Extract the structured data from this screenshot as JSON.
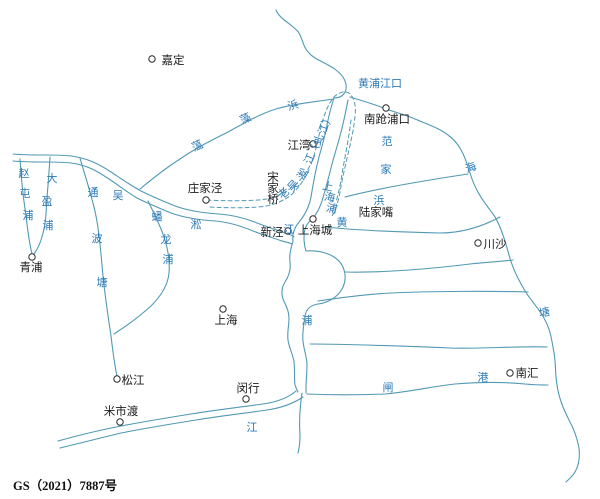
{
  "map": {
    "title": "上海水系历史地图",
    "footer": "GS（2021）7887号",
    "colors": {
      "river": "#5199b4",
      "label_blue": "#2b7ab8",
      "label_black": "#1b1b1b",
      "background": "#ffffff"
    },
    "towns": [
      {
        "id": "jiading",
        "name": "嘉定",
        "cx": 152,
        "cy": 59,
        "tx": 173,
        "ty": 64
      },
      {
        "id": "jiangwan",
        "name": "江湾",
        "cx": 313,
        "cy": 144,
        "tx": 299,
        "ty": 149
      },
      {
        "id": "nanqiangpukou",
        "name": "南跄浦口",
        "cx": 386,
        "cy": 108,
        "tx": 387,
        "ty": 123
      },
      {
        "id": "zhuangjiajing",
        "name": "庄家泾",
        "cx": 206,
        "cy": 200,
        "tx": 205,
        "ty": 192
      },
      {
        "id": "songjiaqiao",
        "name": "宋家桥",
        "tx": 273,
        "ty": 181,
        "vertical": true
      },
      {
        "id": "lujiazui",
        "name": "陆家嘴",
        "tx": 376,
        "ty": 216
      },
      {
        "id": "xinjing",
        "name": "新泾",
        "cx": 288,
        "cy": 231,
        "tx": 272,
        "ty": 236
      },
      {
        "id": "shanghaicheng",
        "name": "上海城",
        "cx": 313,
        "cy": 219,
        "tx": 315,
        "ty": 234
      },
      {
        "id": "chuansha",
        "name": "川沙",
        "cx": 478,
        "cy": 243,
        "tx": 495,
        "ty": 248
      },
      {
        "id": "qingpu",
        "name": "青浦",
        "cx": 32,
        "cy": 257,
        "tx": 31,
        "ty": 271
      },
      {
        "id": "shanghai",
        "name": "上海",
        "cx": 223,
        "cy": 309,
        "tx": 226,
        "ty": 324
      },
      {
        "id": "songjiang",
        "name": "松江",
        "cx": 117,
        "cy": 379,
        "tx": 133,
        "ty": 384
      },
      {
        "id": "minhang",
        "name": "闵行",
        "cx": 246,
        "cy": 399,
        "tx": 248,
        "ty": 392
      },
      {
        "id": "mishidu",
        "name": "米市渡",
        "cx": 120,
        "cy": 422,
        "tx": 121,
        "ty": 415
      },
      {
        "id": "nanhui",
        "name": "南汇",
        "cx": 510,
        "cy": 373,
        "tx": 527,
        "ty": 377
      }
    ],
    "river_labels": [
      {
        "t": "黄浦江口",
        "x": 380,
        "y": 87,
        "s": 11.5
      },
      {
        "t": "蕰",
        "x": 199,
        "y": 149,
        "r": -25
      },
      {
        "t": "藻",
        "x": 247,
        "y": 122,
        "r": -25
      },
      {
        "t": "浜",
        "x": 294,
        "y": 109,
        "r": -15
      },
      {
        "t": "海",
        "x": 472,
        "y": 171,
        "r": -20,
        "s": 12
      },
      {
        "t": "塘",
        "x": 545,
        "y": 316,
        "r": -10,
        "s": 12
      },
      {
        "t": "范",
        "x": 387,
        "y": 145
      },
      {
        "t": "家",
        "x": 386,
        "y": 173
      },
      {
        "t": "浜",
        "x": 379,
        "y": 204
      },
      {
        "t": "老",
        "x": 286,
        "y": 196,
        "r": -40
      },
      {
        "t": "吴",
        "x": 296,
        "y": 188,
        "r": -48
      },
      {
        "t": "淞",
        "x": 306,
        "y": 176,
        "r": -58
      },
      {
        "t": "江",
        "x": 313,
        "y": 160,
        "r": -68
      },
      {
        "t": "（",
        "x": 318,
        "y": 151,
        "r": -72
      },
      {
        "t": "虬",
        "x": 322,
        "y": 141,
        "r": -72
      },
      {
        "t": "江",
        "x": 327,
        "y": 130,
        "r": -72
      },
      {
        "t": "）",
        "x": 331,
        "y": 120,
        "r": -72
      },
      {
        "t": "上",
        "x": 327,
        "y": 190,
        "r": 12
      },
      {
        "t": "海",
        "x": 329,
        "y": 201,
        "r": 12
      },
      {
        "t": "浦",
        "x": 331,
        "y": 212,
        "r": 12
      },
      {
        "t": "黄",
        "x": 342,
        "y": 226,
        "s": 12.5
      },
      {
        "t": "浦",
        "x": 307,
        "y": 324,
        "s": 12.5
      },
      {
        "t": "江",
        "x": 252,
        "y": 431,
        "s": 12.5
      },
      {
        "t": "吴",
        "x": 118,
        "y": 199,
        "s": 12
      },
      {
        "t": "淞",
        "x": 196,
        "y": 228,
        "s": 12
      },
      {
        "t": "江",
        "x": 289,
        "y": 233,
        "s": 12
      },
      {
        "t": "闸",
        "x": 388,
        "y": 391
      },
      {
        "t": "港",
        "x": 483,
        "y": 381
      },
      {
        "t": "赵",
        "x": 24,
        "y": 177
      },
      {
        "t": "屯",
        "x": 25,
        "y": 197
      },
      {
        "t": "浦",
        "x": 28,
        "y": 219
      },
      {
        "t": "大",
        "x": 52,
        "y": 182
      },
      {
        "t": "盈",
        "x": 47,
        "y": 205
      },
      {
        "t": "浦",
        "x": 48,
        "y": 229
      },
      {
        "t": "通",
        "x": 93,
        "y": 196
      },
      {
        "t": "波",
        "x": 97,
        "y": 242
      },
      {
        "t": "塘",
        "x": 102,
        "y": 286
      },
      {
        "t": "蟠",
        "x": 157,
        "y": 220
      },
      {
        "t": "龙",
        "x": 166,
        "y": 243
      },
      {
        "t": "浦",
        "x": 168,
        "y": 263
      }
    ]
  }
}
